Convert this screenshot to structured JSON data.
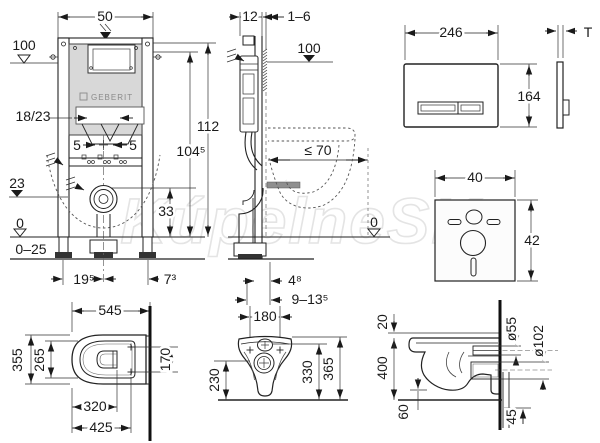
{
  "watermark": "KúpelneSK",
  "frame_front": {
    "brand": "GEBERIT",
    "width_50": "50",
    "level_100": "100",
    "supply_18_23": "18/23",
    "offset_left_5": "5",
    "offset_right_5": "5",
    "level_23": "23",
    "outlet_33": "33",
    "level_0": "0",
    "floor_range_0_25": "0–25",
    "bolt_19_5": "19⁵",
    "bolt_7_3": "7³",
    "height_104_5": "104⁵",
    "height_112": "112"
  },
  "frame_side": {
    "rail_depth_12": "12",
    "finish_1_6": "1–6",
    "level_100": "100",
    "bowl_depth_70": "≤ 70",
    "level_0": "0",
    "wall_4_8": "4⁸",
    "wall_9_13_5": "9–13⁵"
  },
  "flush_plate": {
    "width_246": "246",
    "height_164": "164",
    "thickness_T": "T"
  },
  "insulation_mat": {
    "width_40": "40",
    "height_42": "42"
  },
  "wc_top": {
    "depth_545": "545",
    "width_355": "355",
    "inner_265": "265",
    "front_320": "320",
    "depth_425": "425",
    "holes_170": "170"
  },
  "wc_front": {
    "holes_180": "180",
    "h_230": "230",
    "h_330": "330",
    "h_365": "365"
  },
  "wc_side": {
    "top_20": "20",
    "height_400": "400",
    "bottom_60": "60",
    "below_45": "45",
    "dia_55": "ø55",
    "dia_102": "ø102"
  }
}
